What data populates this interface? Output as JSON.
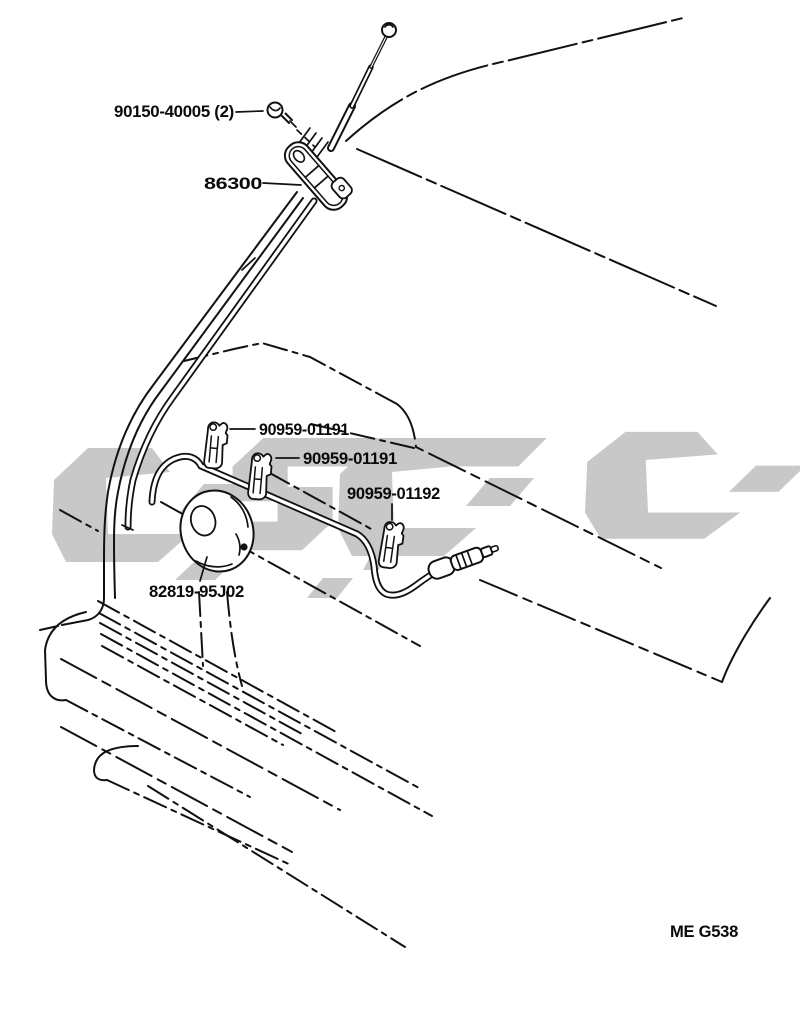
{
  "diagram": {
    "title": "antenna parts diagram",
    "figure_code": "ME G538",
    "parts": [
      {
        "part_number": "90150-40005 (2)",
        "component": "mounting-screw"
      },
      {
        "part_number": "86300",
        "component": "antenna-assembly"
      },
      {
        "part_number": "90959-01191",
        "component": "cable-clamp-1"
      },
      {
        "part_number": "90959-01191",
        "component": "cable-clamp-2"
      },
      {
        "part_number": "90959-01192",
        "component": "cable-clamp-3"
      },
      {
        "part_number": "82819-95J02",
        "component": "grommet"
      }
    ],
    "colors": {
      "line": "#111111",
      "background": "#ffffff",
      "watermark": "#c8c8c8",
      "text": "#0a0a0a"
    }
  }
}
